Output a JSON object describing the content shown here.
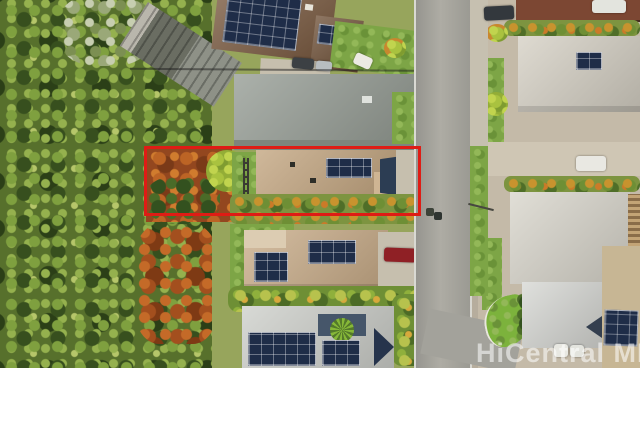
{
  "photo": {
    "watermark_text": "HiCentral MLS",
    "boundary": {
      "color": "#df1c15",
      "style_attr": "border-color:#df1c15"
    },
    "palette": {
      "forest_green": "#57702c",
      "lawn_green": "#7da546",
      "dirt_red": "#93471f",
      "road_gray": "#a3a29b",
      "roof_brown": "#7a5a40",
      "roof_tan": "#c2a47e",
      "roof_gray": "#949b93",
      "roof_white": "#d5d0c4",
      "solar_navy": "#1f2d48",
      "accent_red_car": "#8f2025",
      "page_background": "#ffffff"
    }
  }
}
